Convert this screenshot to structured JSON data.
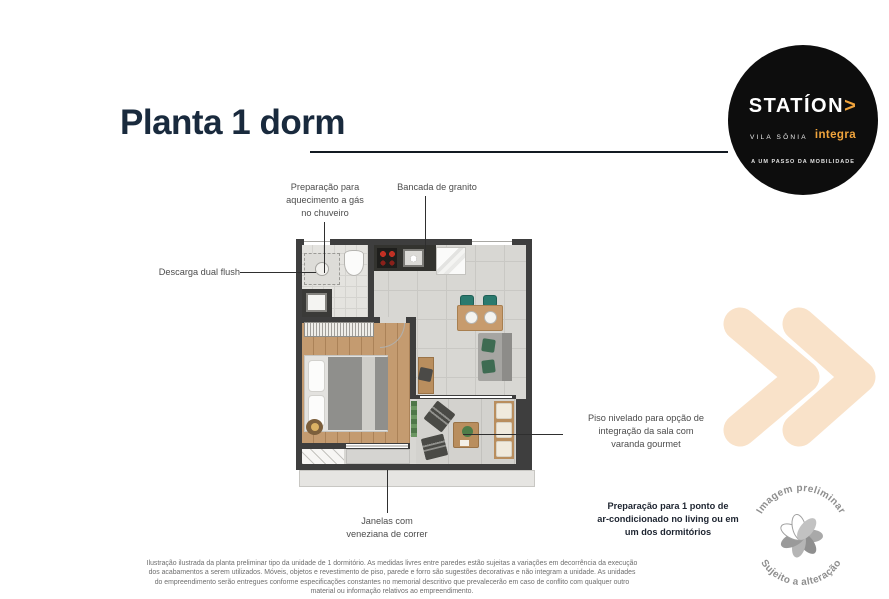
{
  "title": "Planta 1 dorm",
  "logo": {
    "brand": "STATÍON",
    "arrow": ">",
    "location": "VILA SÔNIA",
    "sub_brand": "integra",
    "tagline": "A UM PASSO DA MOBILIDADE"
  },
  "callouts": {
    "gas_heater": "Preparação para\naquecimento a gás\nno chuveiro",
    "granite_counter": "Bancada de granito",
    "dual_flush": "Descarga dual flush",
    "level_floor": "Piso nivelado para opção de\nintegração da sala com\nvaranda gourmet",
    "windows": "Janelas com\nveneziana de correr",
    "ac_note": "Preparação para 1 ponto de\nar-condicionado no living ou em\num dos dormitórios"
  },
  "stamp": {
    "top_text": "Imagem preliminar",
    "bottom_text": "Sujeito a alteração"
  },
  "disclaimer": "Ilustração ilustrada da planta preliminar tipo da unidade de 1 dormitório. As medidas livres entre paredes estão sujeitas a variações em decorrência da execução dos acabamentos a serem utilizados. Móveis, objetos e revestimento de piso, parede e forro são sugestões decorativas e não integram a unidade. As unidades do empreendimento serão entregues conforme especificações constantes no memorial descritivo que prevalecerão em caso de conflito com qualquer outro material ou informação relativos ao empreendimento.",
  "colors": {
    "title": "#192A3D",
    "accent_orange": "#F0A43C",
    "logo_background": "#0D0D0D",
    "chevron": "#F9E2C9",
    "wall": "#3E3E3E"
  }
}
